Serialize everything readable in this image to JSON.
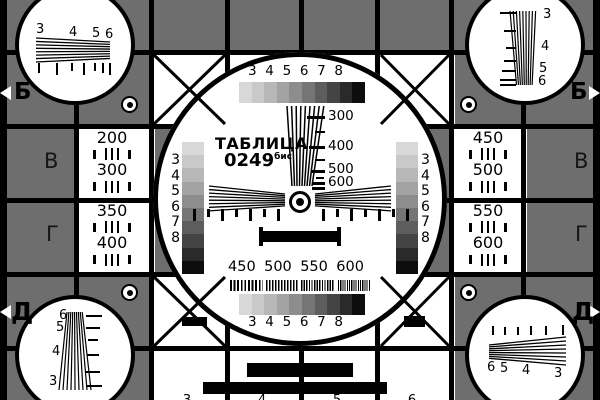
{
  "colors": {
    "background_gray": "#6e6e6e",
    "black": "#000000",
    "white": "#ffffff"
  },
  "grayscale_steps": [
    "#d8d8d8",
    "#c9c9c9",
    "#b7b7b7",
    "#a3a3a3",
    "#8d8d8d",
    "#757575",
    "#5d5d5d",
    "#444444",
    "#2a2a2a",
    "#0d0d0d"
  ],
  "title": {
    "line1": "ТАБЛИЦА",
    "line2": "0249",
    "line2_sup": "бис"
  },
  "center": {
    "top_scale_labels": [
      "3",
      "4",
      "5",
      "6",
      "7",
      "8"
    ],
    "bottom_scale_labels": [
      "3",
      "4",
      "5",
      "6",
      "7",
      "8"
    ],
    "left_column_labels": [
      "3",
      "4",
      "5",
      "6",
      "7",
      "8"
    ],
    "right_column_labels": [
      "3",
      "4",
      "5",
      "6",
      "7",
      "8"
    ],
    "wedge_scale": [
      "300",
      "400",
      "500",
      "600"
    ],
    "burst_labels": [
      "450",
      "500",
      "550",
      "600"
    ]
  },
  "panels": {
    "left_top": [
      "200",
      "300"
    ],
    "left_bottom": [
      "350",
      "400"
    ],
    "right_top": [
      "450",
      "500"
    ],
    "right_bottom": [
      "550",
      "600"
    ]
  },
  "corners": {
    "top_left": [
      "3",
      "4",
      "5",
      "6"
    ],
    "top_right": [
      "3",
      "4",
      "5",
      "6"
    ],
    "bottom_left": [
      "6",
      "5",
      "4",
      "3"
    ],
    "bottom_right": [
      "6",
      "5",
      "4",
      "3"
    ]
  },
  "edge_letters": {
    "left_b": "Б",
    "right_b": "Б",
    "left_v": "В",
    "right_v": "В",
    "left_g": "Г",
    "right_g": "Г",
    "left_d": "Д",
    "right_d": "Д"
  },
  "cut_digits": {
    "top": [
      "3",
      "4",
      "5",
      "6"
    ],
    "bottom": [
      "3",
      "4",
      "5",
      "6"
    ]
  }
}
